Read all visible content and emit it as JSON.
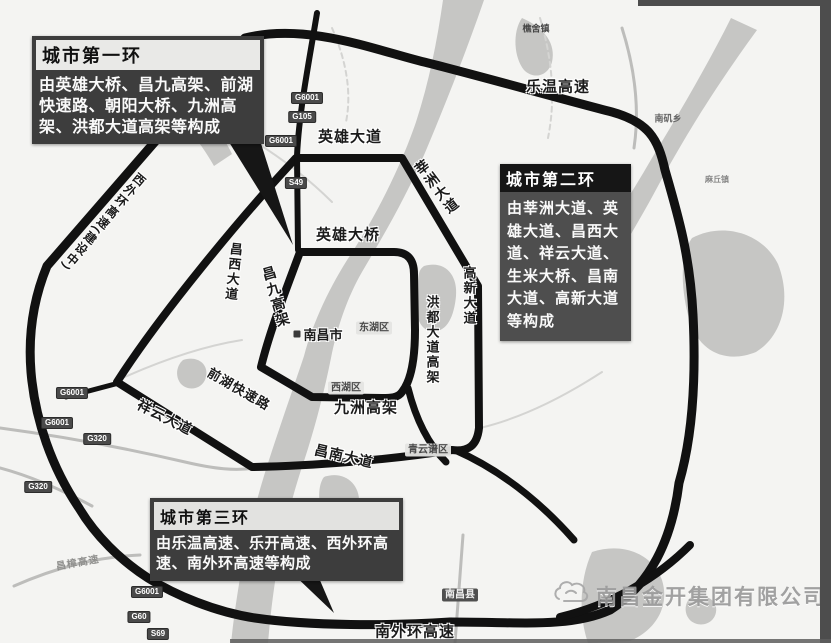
{
  "callouts": {
    "ring1": {
      "title": "城市第一环",
      "body": "由英雄大桥、昌九高架、前湖快速路、朝阳大桥、九洲高架、洪都大道高架等构成"
    },
    "ring2": {
      "title": "城市第二环",
      "body": "由莘洲大道、英雄大道、昌西大道、祥云大道、生米大桥、昌南大道、高新大道等构成"
    },
    "ring3": {
      "title": "城市第三环",
      "body": "由乐温高速、乐开高速、西外环高速、南外环高速等构成"
    }
  },
  "roads": {
    "lewen_expwy": "乐温高速",
    "yingxiong_ave": "英雄大道",
    "yingxiong_bridge": "英雄大桥",
    "xinzhou_ave": "莘洲大道",
    "changxi_ave": "昌西大道",
    "changjiu_viaduct": "昌九高架",
    "qianhu_expressway": "前湖快速路",
    "hongdu_viaduct": "洪都大道高架",
    "gaoxin_ave": "高新大道",
    "jiuzhou_viaduct": "九洲高架",
    "xiangyun_ave": "祥云大道",
    "changnan_ave": "昌南大道",
    "south_outer_ring": "南外环高速",
    "west_outer_ring": "西外环高速(建设中)",
    "changzhang_expwy": "昌樟高速"
  },
  "places": {
    "city": "南昌市",
    "donghu": "东湖区",
    "xihu": "西湖区",
    "qingyunpu": "青云谱区",
    "nanchang_county": "南昌县",
    "qiaoshe": "樵舍镇",
    "nanji": "南矶乡",
    "maqiu": "麻丘镇"
  },
  "shields": {
    "s1": "G6001",
    "s2": "G105",
    "s3": "G6001",
    "s4": "S49",
    "s5": "G6001",
    "s6": "G6001",
    "s7": "G320",
    "s8": "G320",
    "s9": "G6001",
    "s10": "G60",
    "s11": "S69"
  },
  "watermark": {
    "company": "南昌金开集团有限公司"
  },
  "colors": {
    "ring_road": "#111111",
    "water": "#c6c6c4",
    "map_bg": "#f4f4f2"
  }
}
